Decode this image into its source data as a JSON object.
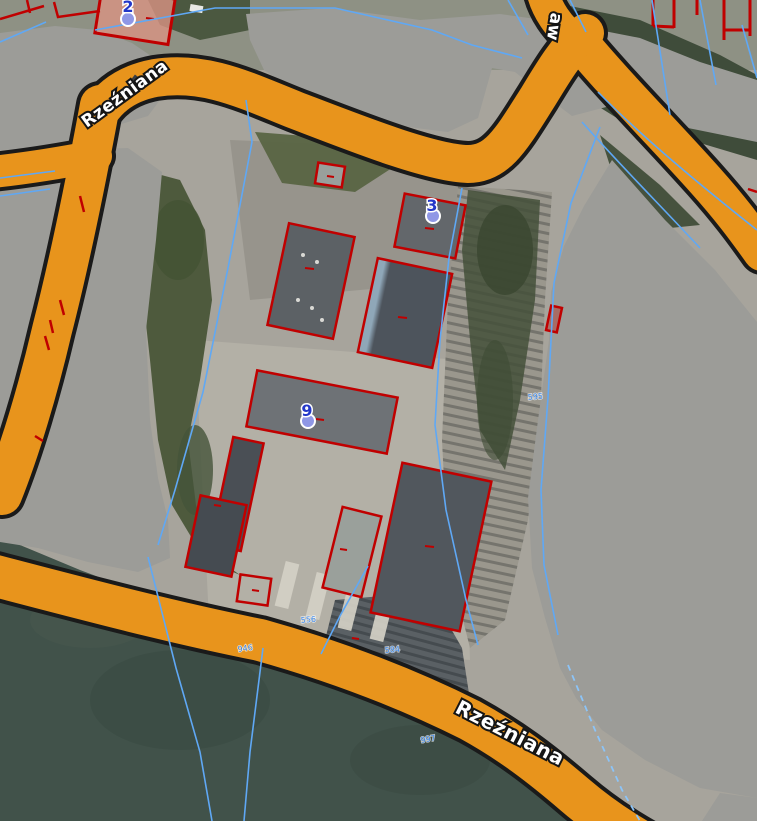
{
  "map": {
    "streets": {
      "rzezniana_top": "Rzeźniana",
      "rzezniana_bottom": "Rzeźniana",
      "partial_vertical": "aw"
    },
    "markers": [
      {
        "id": "marker-2",
        "label": "2"
      },
      {
        "id": "marker-3",
        "label": "3"
      },
      {
        "id": "marker-9",
        "label": "9"
      }
    ],
    "parcel_labels": [
      {
        "id": "parcel-946",
        "label": "946"
      },
      {
        "id": "parcel-584",
        "label": "584"
      },
      {
        "id": "parcel-997",
        "label": "997"
      },
      {
        "id": "parcel-595",
        "label": "595"
      },
      {
        "id": "parcel-556",
        "label": "556"
      }
    ],
    "colors": {
      "road_fill": "#E8941C",
      "road_casing": "#1a1a1a",
      "building_outline": "#C00000",
      "parcel_line": "#5FA8F5",
      "parcel_line_dash": "#8CC4F8",
      "privacy_mask": "#9C9C98",
      "field_green": "#41524A",
      "marker_fill": "#8F97E6",
      "marker_number": "#2438C8",
      "label_text": "#FFFFFF"
    }
  }
}
